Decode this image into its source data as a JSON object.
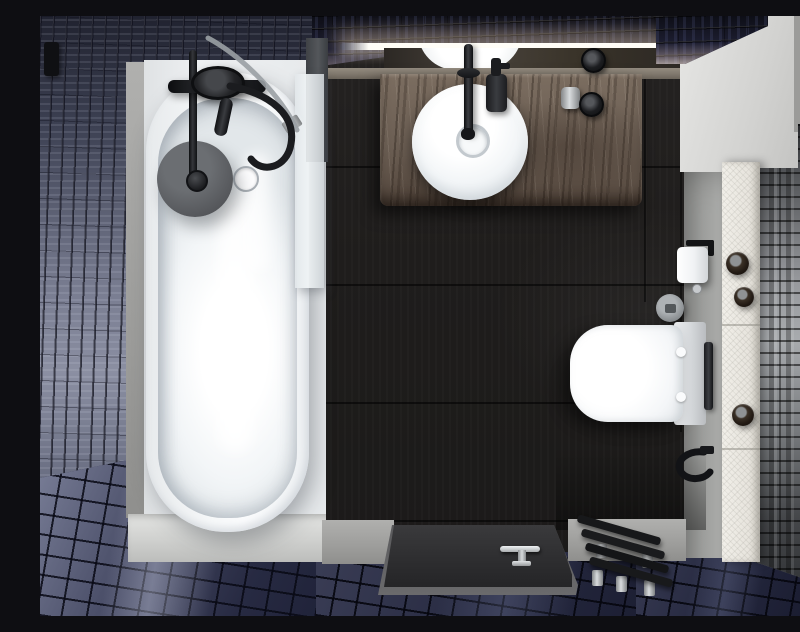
{
  "scene": {
    "title": "Top-down 3D render of a modern black-and-white bathroom with navy glossy tiles",
    "view": "bird's-eye / floor plan perspective",
    "style": "photorealistic interior render, no text or UI elements visible"
  },
  "palette": {
    "navy_tile": "#1c1d30",
    "blue_gray_tile": "#787c90",
    "floor_tile_blue": "#30334c",
    "dark_wood_floor": "#201e1d",
    "vanity_wood": "#6e6156",
    "white_ceramic": "#f4f6f7",
    "concrete_gray": "#a0a09e",
    "stone_ledge": "#eceae4",
    "gray_wall_tile": "#97999d",
    "matte_black_fixture": "#141517",
    "chrome": "#d9dcde",
    "shower_head_gray": "#595c60",
    "led_light": "#fff6e8"
  },
  "objects": {
    "ceiling_light": {
      "label": "illuminated LED strip above vanity mirror"
    },
    "mirror": {
      "label": "mirror strip reflecting vessel sink and light"
    },
    "left_wall": {
      "label": "left wall with glossy blue-gray subway tiles"
    },
    "top_wall": {
      "label": "back wall with dark navy tiles and warm light glow"
    },
    "bathtub": {
      "label": "white oval freestanding bathtub in alcove"
    },
    "shower_disc": {
      "label": "gray rain shower head over bathtub"
    },
    "tub_fixture": {
      "label": "matte black bath mixer with hand shower and hoses"
    },
    "glass_screen": {
      "label": "glass bath screen with chrome bracket"
    },
    "vanity": {
      "label": "dark oak vanity counter"
    },
    "sink": {
      "label": "round white vessel sink"
    },
    "faucet": {
      "label": "tall matte black faucet"
    },
    "soap_dispenser": {
      "label": "black soap dispenser"
    },
    "counter_knobs": {
      "label": "black cosmetic jars on counter"
    },
    "dark_floor": {
      "label": "dark charcoal wood plank floor"
    },
    "toilet": {
      "label": "wall-hung white toilet, top view"
    },
    "toilet_paper": {
      "label": "toilet paper roll on black holder"
    },
    "flush_button": {
      "label": "round gray flush control"
    },
    "towel_rail": {
      "label": "black vertical towel rail"
    },
    "towel_hook": {
      "label": "black towel hook"
    },
    "stone_ledge": {
      "label": "white stone ledge with three dark round pots"
    },
    "right_wall": {
      "label": "right wall with glossy gray stacked tiles"
    },
    "shower_tray": {
      "label": "black low-profile shower tray with chrome drain handle"
    },
    "bench": {
      "label": "black slatted shower bench with chrome feet"
    },
    "tile_floor": {
      "label": "navy blue glossy mosaic tile floor"
    }
  }
}
